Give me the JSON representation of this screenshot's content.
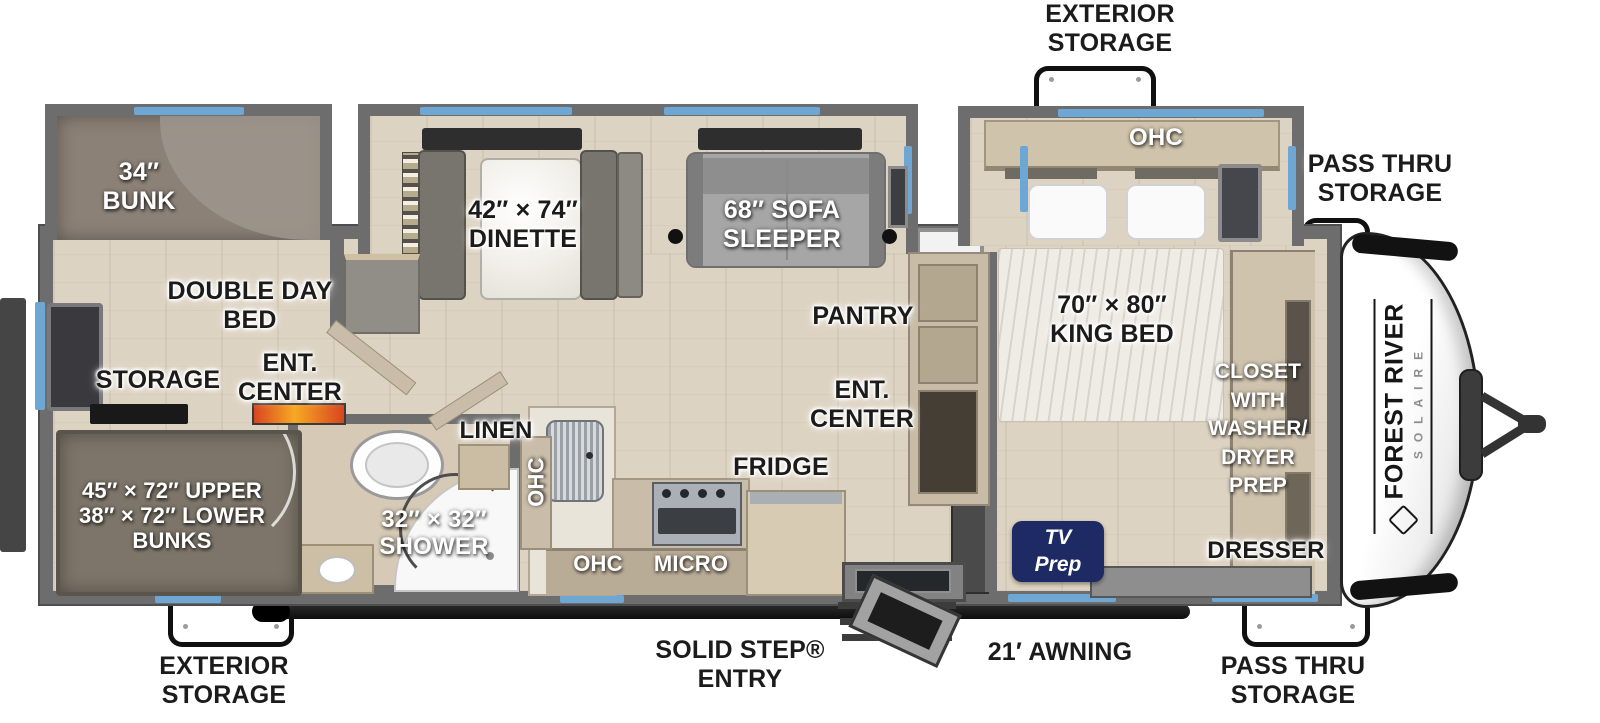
{
  "brand": {
    "name": "FOREST RIVER",
    "model": "SOLAIRE"
  },
  "colors": {
    "wall_gray": "#6d6d6d",
    "window_blue": "#6fa7d4",
    "floor_beige": "#ddd3c2",
    "carpet_taupe": "#8b8177",
    "tv_prep_navy": "#1d2a63",
    "label_black": "#1b1b1b",
    "label_white": "#ffffff"
  },
  "labels": {
    "exterior_storage_top": "EXTERIOR\nSTORAGE",
    "pass_thru_top": "PASS THRU\nSTORAGE",
    "ohc_bedroom": "OHC",
    "bunk_34": "34″\nBUNK",
    "dinette": "42″ × 74″\nDINETTE",
    "sofa": "68″ SOFA\nSLEEPER",
    "pantry": "PANTRY",
    "double_day_bed": "DOUBLE DAY\nBED",
    "storage": "STORAGE",
    "ent_center_bunk": "ENT.\nCENTER",
    "ent_center_main": "ENT.\nCENTER",
    "king_bed": "70″ × 80″\nKING BED",
    "closet": "CLOSET\nWITH\nWASHER/\nDRYER\nPREP",
    "linen": "LINEN",
    "ohc_hall": "OHC",
    "shower": "32″ × 32″\nSHOWER",
    "fridge": "FRIDGE",
    "ohc_kitchen": "OHC",
    "micro": "MICRO",
    "bunks": "45″ × 72″ UPPER\n38″ × 72″ LOWER\nBUNKS",
    "exterior_storage_bottom": "EXTERIOR\nSTORAGE",
    "solid_step_entry": "SOLID STEP®\nENTRY",
    "awning": "21′ AWNING",
    "dresser": "DRESSER",
    "pass_thru_bottom": "PASS THRU\nSTORAGE",
    "tv_prep": "TV\nPrep"
  }
}
